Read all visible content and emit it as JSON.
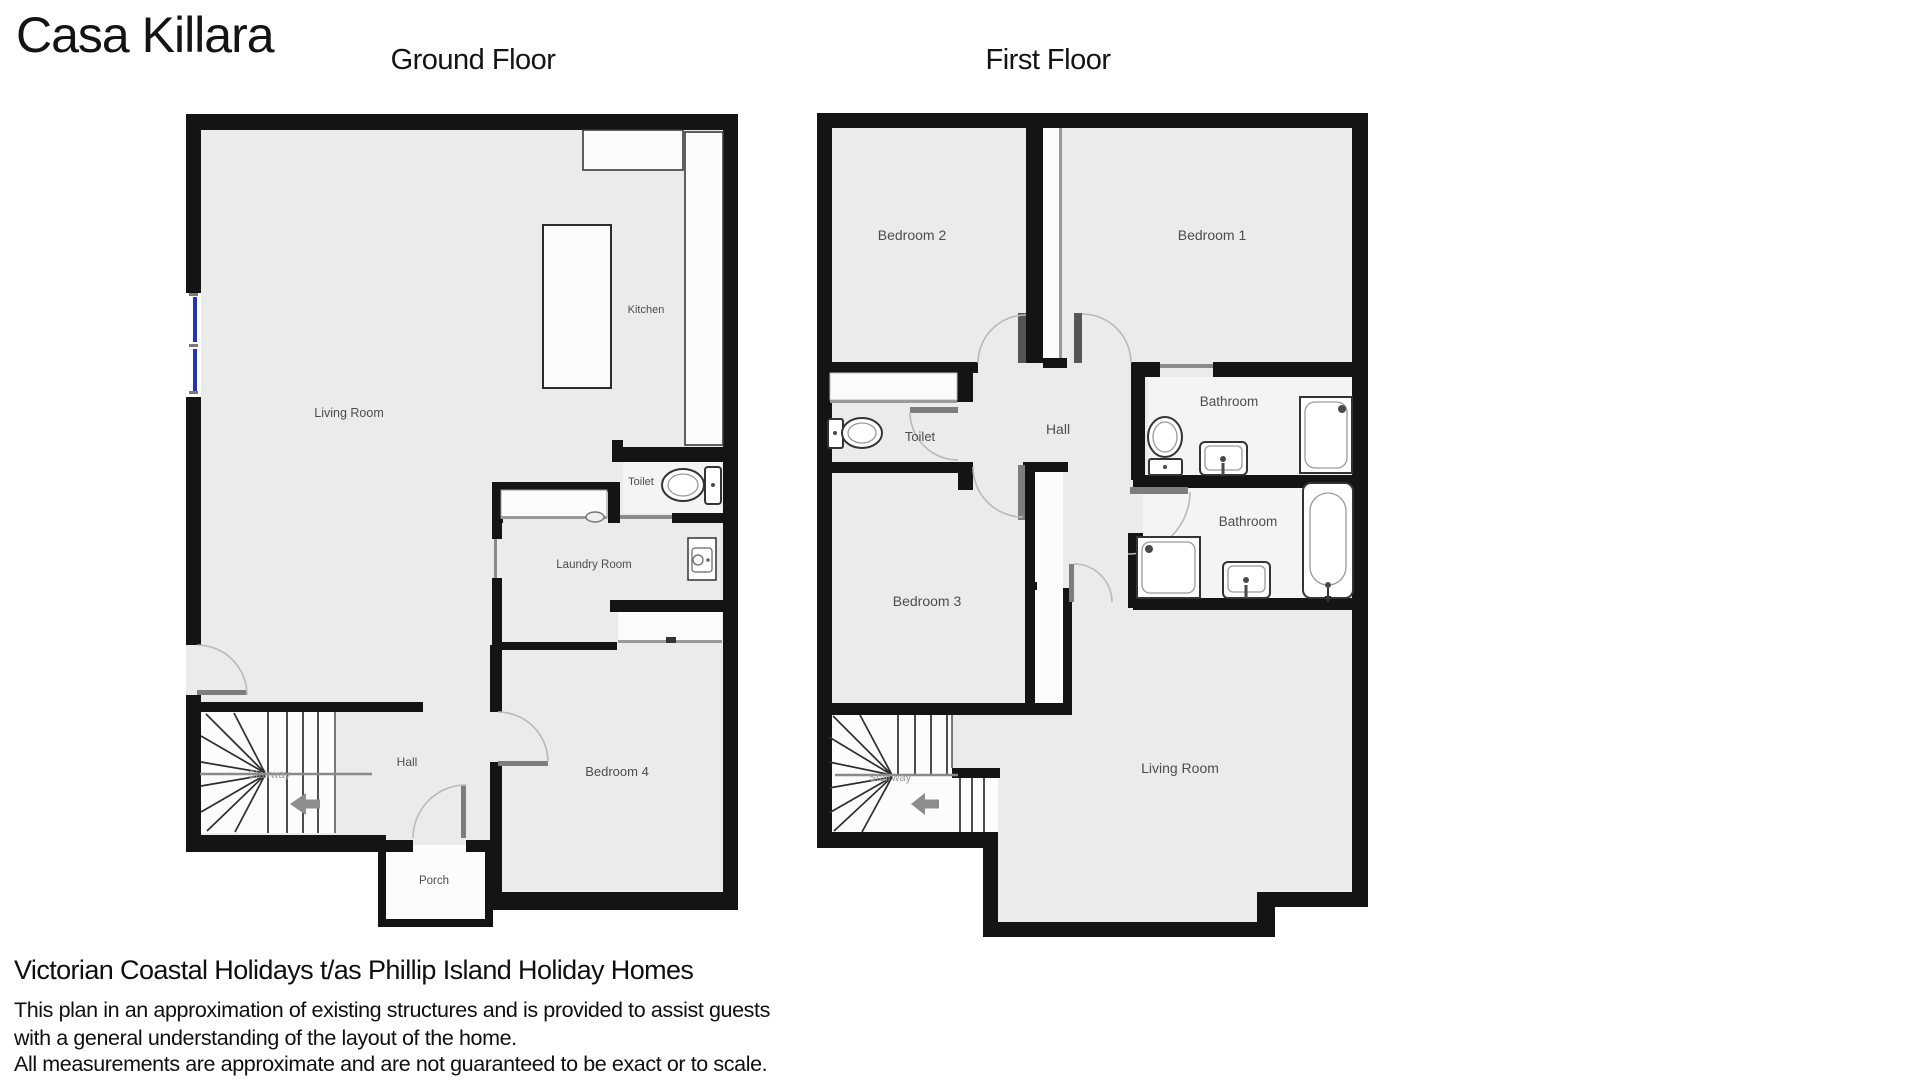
{
  "page_title": "Casa Killara",
  "floors": {
    "ground": {
      "label": "Ground Floor",
      "rooms": {
        "living_room": "Living Room",
        "kitchen": "Kitchen",
        "toilet": "Toilet",
        "laundry_room": "Laundry Room",
        "hall": "Hall",
        "stairway": "Stairway",
        "bedroom_4": "Bedroom 4",
        "porch": "Porch"
      }
    },
    "first": {
      "label": "First Floor",
      "rooms": {
        "bedroom_2": "Bedroom 2",
        "bedroom_1": "Bedroom 1",
        "toilet": "Toilet",
        "hall": "Hall",
        "bathroom_ensuite": "Bathroom",
        "bathroom_main": "Bathroom",
        "bedroom_3": "Bedroom 3",
        "living_room": "Living Room",
        "stairway": "Stairway"
      }
    }
  },
  "footer": {
    "company": "Victorian Coastal Holidays t/as Phillip Island Holiday Homes",
    "disclaimer_1": "This plan in an approximation of existing structures and is provided to assist guests",
    "disclaimer_2": "with a general understanding of the layout of the home.",
    "disclaimer_3": "All measurements are approximate and are not guaranteed to be exact or to scale."
  },
  "colors": {
    "wall": "#141414",
    "floor": "#ebebec",
    "window": "#2233cc",
    "door_leaf": "#7d7d7d",
    "label": "#4d4d4d"
  }
}
